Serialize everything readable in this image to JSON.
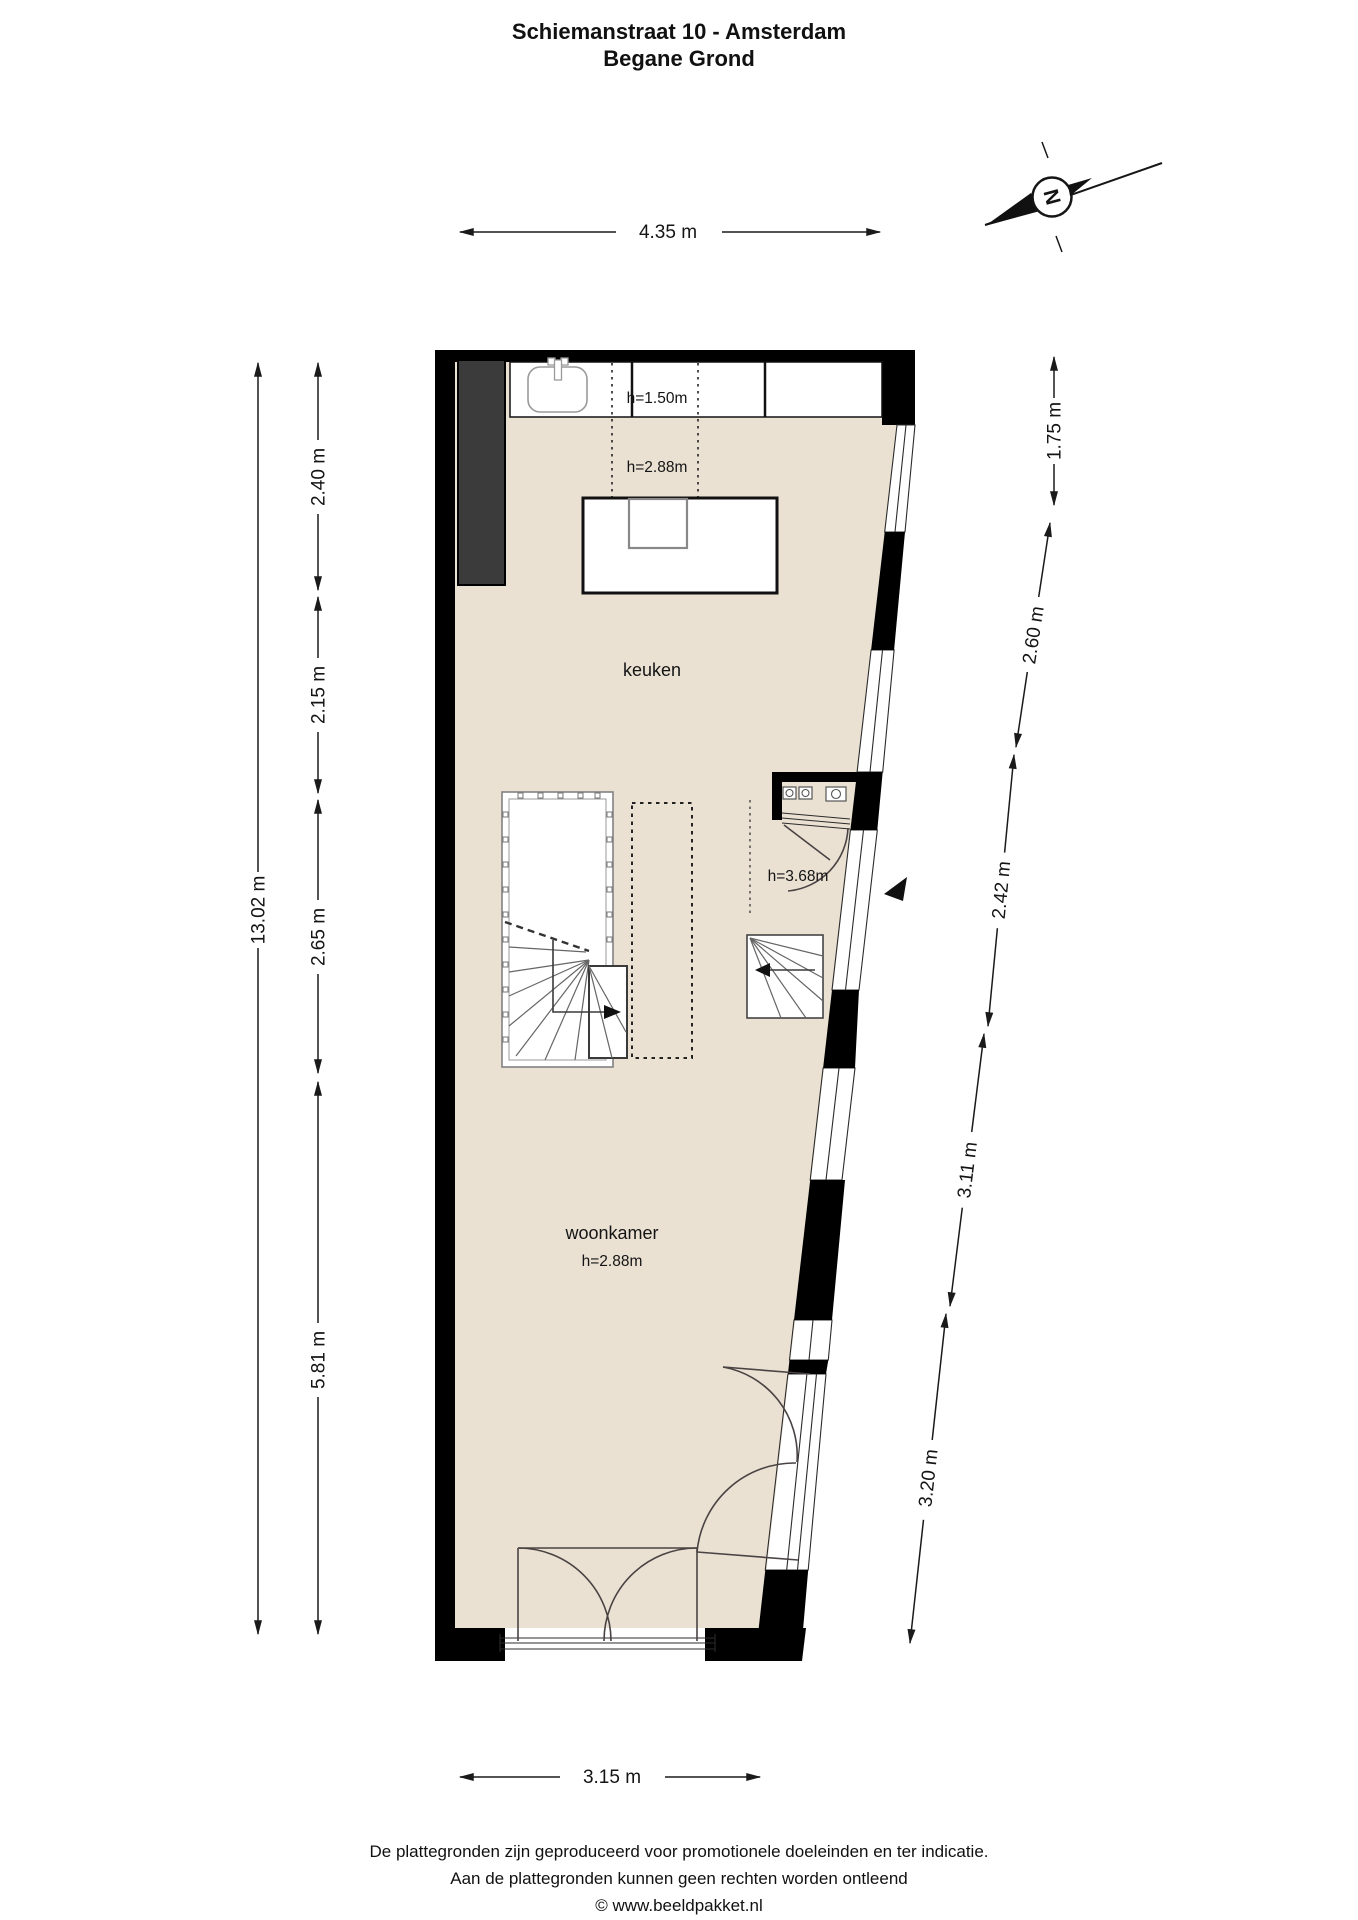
{
  "title": {
    "line1": "Schiemanstraat 10 - Amsterdam",
    "line2": "Begane Grond"
  },
  "compass": {
    "letter": "N"
  },
  "dimensions": {
    "top": "4.35 m",
    "bottom": "3.15 m",
    "left_total": "13.02 m",
    "left_segments": [
      "2.40 m",
      "2.15 m",
      "2.65 m",
      "5.81 m"
    ],
    "right_segments": [
      "1.75 m",
      "2.60 m",
      "2.42 m",
      "3.11 m",
      "3.20 m"
    ]
  },
  "rooms": {
    "keuken": {
      "label": "keuken",
      "ceiling_height": "h=2.88m",
      "counter_height": "h=1.50m"
    },
    "woonkamer": {
      "label": "woonkamer",
      "ceiling_height": "h=2.88m"
    },
    "entree": {
      "ceiling_height": "h=3.68m"
    }
  },
  "footer": {
    "line1": "De plattegronden zijn geproduceerd voor promotionele doeleinden en ter indicatie.",
    "line2": "Aan de plattegronden kunnen geen rechten worden ontleend",
    "line3": "© www.beeldpakket.nl"
  },
  "colors": {
    "floor": "#EAE1D3",
    "wall": "#000000",
    "cabinet": "#3B3B3B",
    "dimension_line": "#1A1A1A"
  }
}
